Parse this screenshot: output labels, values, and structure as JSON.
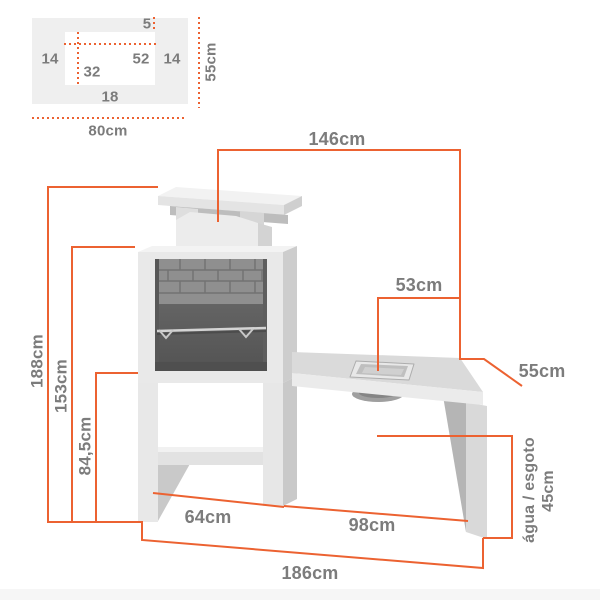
{
  "colors": {
    "dimension_line": "#EC6231",
    "label_text": "#7C7C7C",
    "inset_panel": "#EFEFEF"
  },
  "inset_diagram": {
    "gap_top": "5",
    "wall_left": "14",
    "opening_width": "52",
    "wall_right": "14",
    "inner_depth": "32",
    "front_edge": "18",
    "depth_label": "55cm",
    "width_label": "80cm"
  },
  "dimensions": {
    "overall_width": "146cm",
    "sink_to_edge": "53cm",
    "table_depth": "55cm",
    "overall_height": "188cm",
    "hearth_height": "153cm",
    "worktop_height": "84,5cm",
    "base_width": "64cm",
    "table_span": "98cm",
    "overall_length": "186cm",
    "utility_height": "45cm",
    "utility_label": "água / esgoto"
  }
}
